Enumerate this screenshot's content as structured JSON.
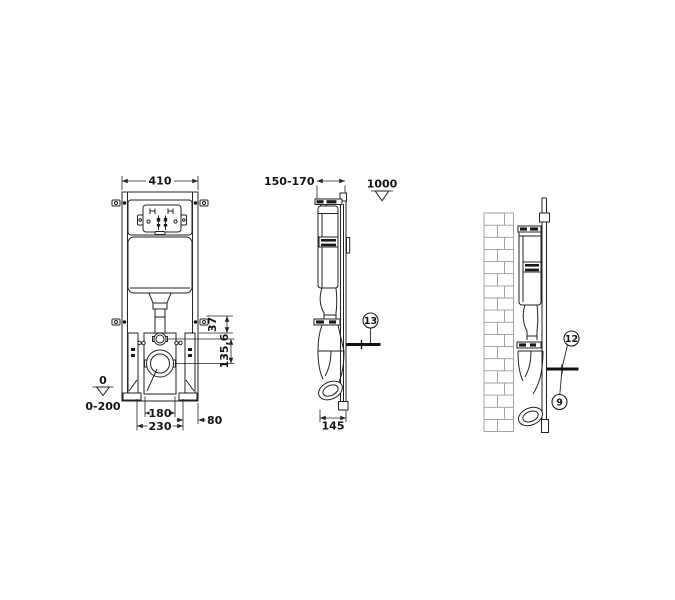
{
  "drawing": {
    "line_color": "#222222",
    "brick_line_color": "#9b9b9b",
    "front_view": {
      "width_dim": "410",
      "offset_dim": "37",
      "drain_height_dim": "135,6",
      "floor_datum_value": "0",
      "floor_datum_range": "0-200",
      "drain_spacing_dim": "180",
      "bolt_spacing_dim": "230",
      "edge_offset_dim": "80"
    },
    "side_view": {
      "depth_dim": "150-170",
      "height_datum_value": "1000",
      "base_depth_dim": "145",
      "callout": "13"
    },
    "wall_view": {
      "callout_top": "12",
      "callout_bottom": "9"
    }
  }
}
